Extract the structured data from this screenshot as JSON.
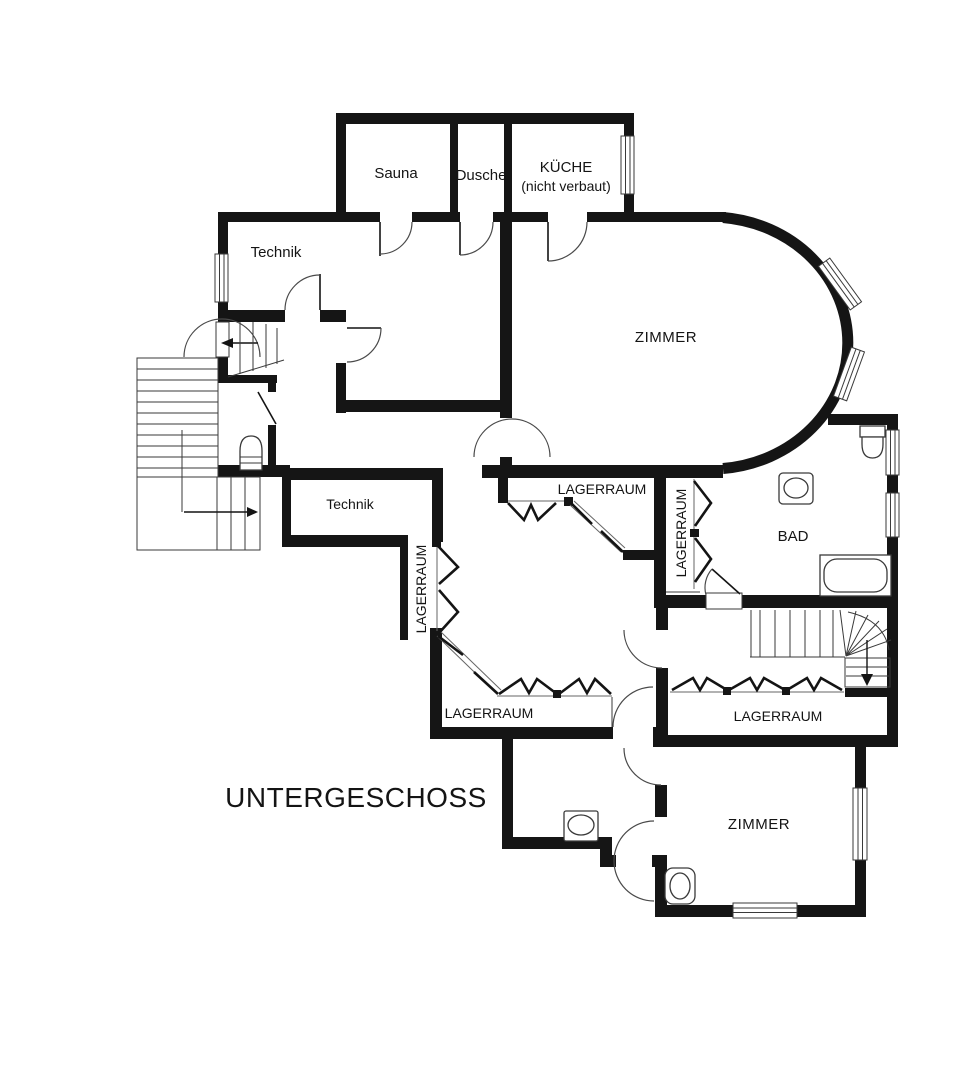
{
  "plan": {
    "title": "UNTERGESCHOSS",
    "labels": {
      "sauna": "Sauna",
      "dusche": "Dusche",
      "kueche": "KÜCHE",
      "kueche_note": "(nicht verbaut)",
      "technik_upper": "Technik",
      "technik_lower": "Technik",
      "zimmer_main": "ZIMMER",
      "zimmer_lower": "ZIMMER",
      "bad": "BAD",
      "lagerraum_hall": "LAGERRAUM",
      "lagerraum_left_vertical": "LAGERRAUM",
      "lagerraum_bad_vertical": "LAGERRAUM",
      "lagerraum_bottom_center": "LAGERRAUM",
      "lagerraum_bottom_right": "LAGERRAUM"
    },
    "colors": {
      "wall": "#151515",
      "line": "#3a3a3a",
      "background": "#ffffff"
    }
  }
}
